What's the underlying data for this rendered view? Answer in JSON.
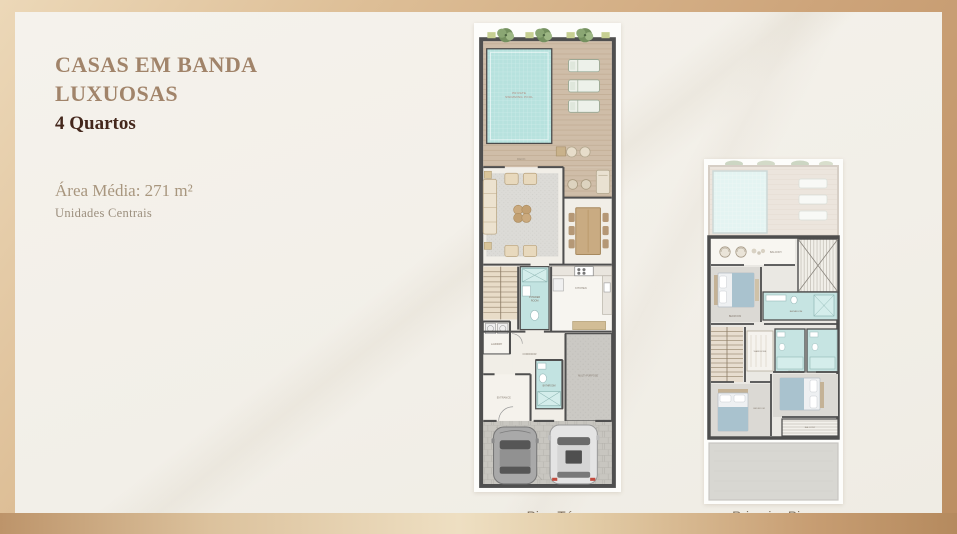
{
  "slide": {
    "title_line1": "CASAS EM BANDA",
    "title_line2": "LUXUOSAS",
    "bedrooms": "4 Quartos",
    "area": "Área Média: 271 m²",
    "units": "Unidades Centrais"
  },
  "plans": {
    "ground": {
      "label": "Piso Térreo",
      "rooms": {
        "pool_line1": "PRIVATE",
        "pool_line2": "SWIMMING POOL",
        "deck": "DECK",
        "kitchen": "KITCHEN",
        "powder_line1": "POWDER",
        "powder_line2": "ROOM",
        "laundry": "LAUNDRY",
        "corridor": "CORRIDOR",
        "entrance": "ENTRANCE",
        "multi": "MULTI-PURPOSE",
        "bathroom": "BATHROOM"
      }
    },
    "first": {
      "label": "Primeiro Piso",
      "rooms": {
        "balcony": "BALCONY",
        "bedroom": "BEDROOM",
        "bathroom": "BATHROOM",
        "wardrobe": "WARDROBE"
      }
    }
  },
  "colors": {
    "title": "#a1846a",
    "quartos": "#44271c",
    "area": "#a8967e",
    "units": "#9c8f7e",
    "plan_label": "#83735f",
    "frame_light": "#ecd8b8",
    "frame_dark": "#bb8e62",
    "canvas_bg": "#f3f0e9",
    "wall": "#4f4f4f",
    "pool": "#b7e2de",
    "deck": "#cfbda8",
    "tile": "#c2e3e1",
    "carpet": "#cbc9c4",
    "wood": "#e8dcc8",
    "bed_blanket": "#a9c2ce"
  }
}
